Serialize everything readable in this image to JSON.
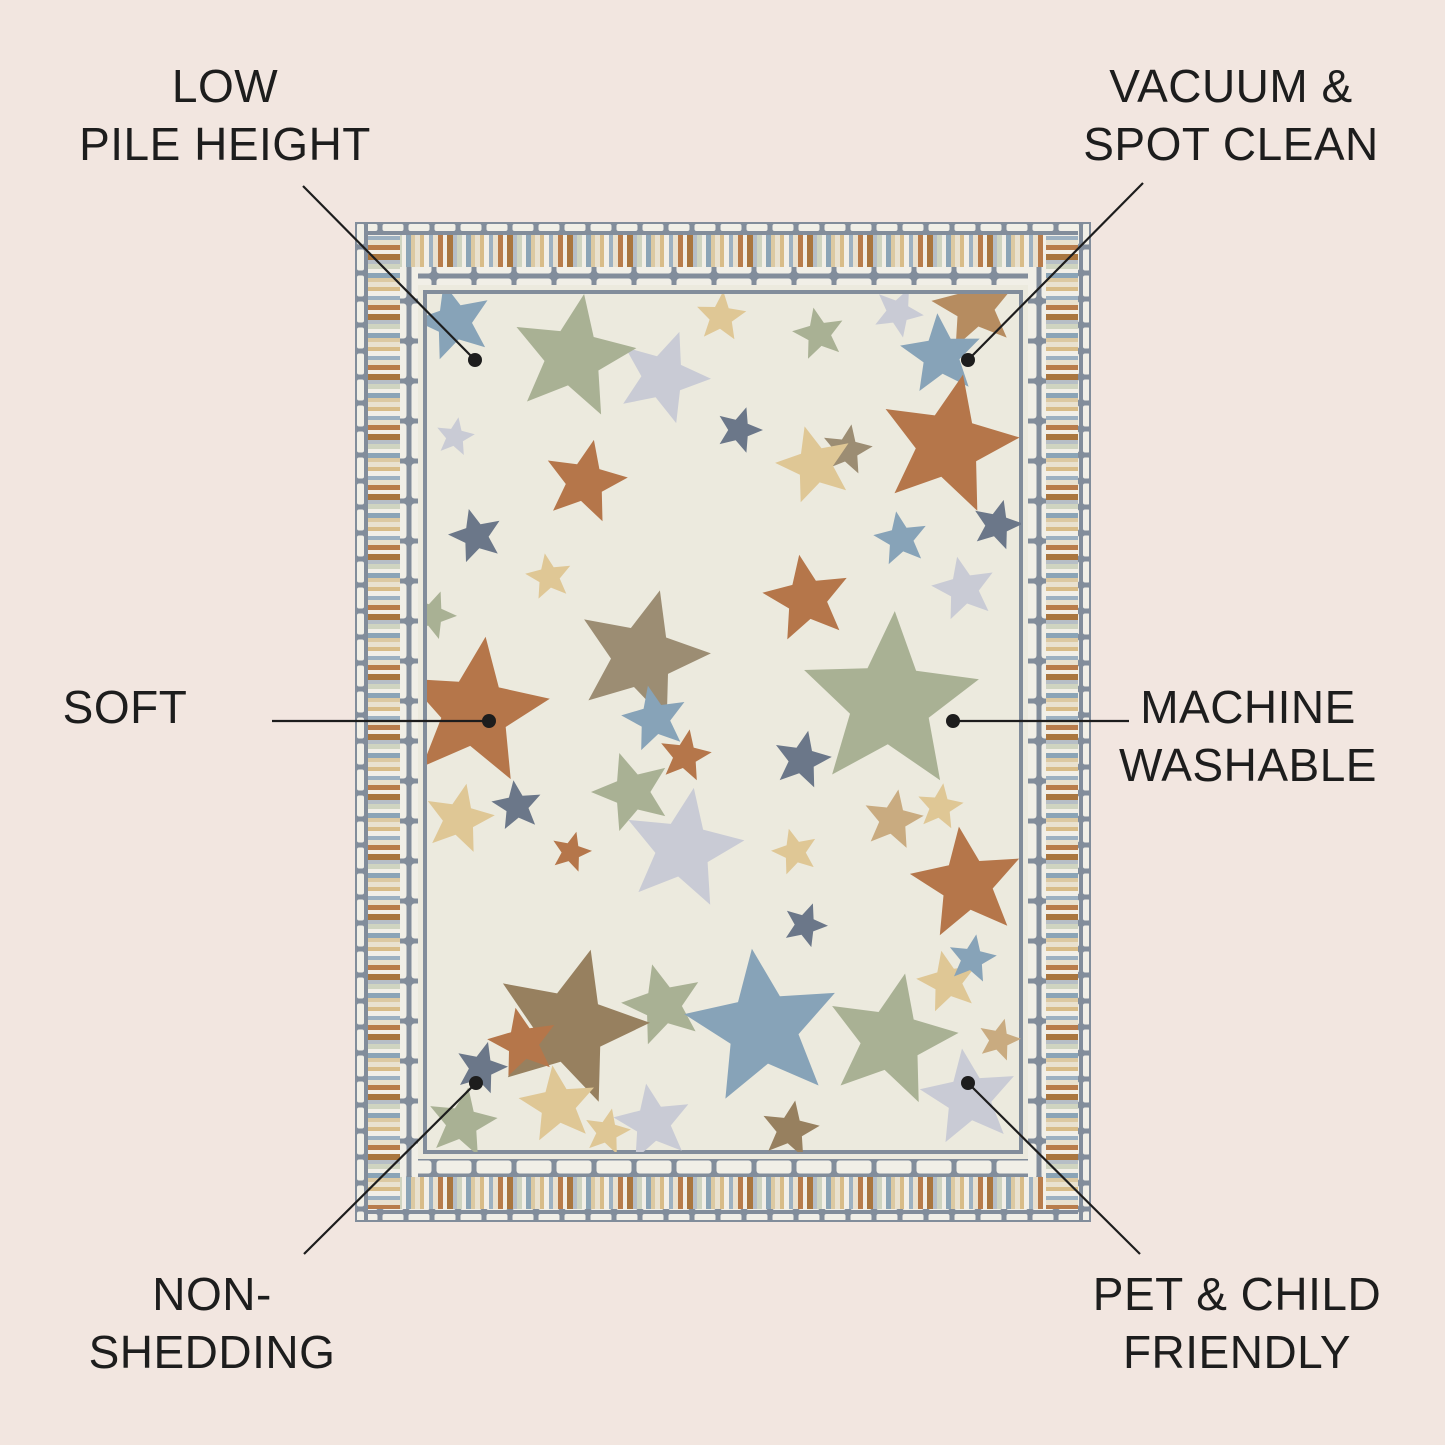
{
  "page": {
    "background": "#f2e6e0",
    "text_color": "#1d1d1d",
    "line_color": "#1d1d1d",
    "dot_radius": 7
  },
  "features": {
    "low_pile": {
      "line1": "LOW",
      "line2": "PILE HEIGHT"
    },
    "vacuum": {
      "line1": "VACUUM &",
      "line2": "SPOT CLEAN"
    },
    "soft": {
      "line1": "SOFT"
    },
    "machine_washable": {
      "line1": "MACHINE",
      "line2": "WASHABLE"
    },
    "non_shedding": {
      "line1": "NON-",
      "line2": "SHEDDING"
    },
    "pet_child": {
      "line1": "PET & CHILD",
      "line2": "FRIENDLY"
    }
  },
  "callouts": [
    {
      "name": "low-pile",
      "x1": 303,
      "y1": 186,
      "x2": 475,
      "y2": 360
    },
    {
      "name": "vacuum-spot-clean",
      "x1": 1143,
      "y1": 183,
      "x2": 968,
      "y2": 360
    },
    {
      "name": "soft",
      "x1": 272,
      "y1": 721,
      "x2": 489,
      "y2": 721
    },
    {
      "name": "machine-washable",
      "x1": 1129,
      "y1": 721,
      "x2": 953,
      "y2": 721
    },
    {
      "name": "non-shedding",
      "x1": 304,
      "y1": 1254,
      "x2": 476,
      "y2": 1083
    },
    {
      "name": "pet-child-friendly",
      "x1": 1140,
      "y1": 1254,
      "x2": 968,
      "y2": 1083
    }
  ],
  "rug": {
    "x": 355,
    "y": 222,
    "width": 736,
    "height": 1000,
    "field_color": "#eceade",
    "border_gray": "#828d9b",
    "brick_color": "#f1efe7",
    "stripe_widths": [
      5,
      4,
      5,
      4,
      5,
      5,
      4,
      6,
      4,
      5,
      4,
      5,
      4
    ],
    "stripe_colors": [
      "#e9e1cf",
      "#d8bc88",
      "#f2efe7",
      "#9db1c1",
      "#e9e1cf",
      "#b87c4b",
      "#f2efe7",
      "#a9763f",
      "#b6bec6",
      "#cfd4c0",
      "#f2efe7",
      "#8ba4b6",
      "#dcc9a2"
    ],
    "star_colors": {
      "blue": "#87a3b8",
      "sage": "#a9b194",
      "lgray": "#c9cbd5",
      "gold": "#dfc795",
      "rust": "#b5764a",
      "tanbrown": "#b68c60",
      "taupe": "#9c8d73",
      "slate": "#6b7789",
      "brown": "#97805f",
      "tan": "#c9ab80"
    },
    "stars": [
      [
        99,
        100,
        40,
        "blue",
        -15
      ],
      [
        308,
        155,
        48,
        "lgray",
        20
      ],
      [
        218,
        135,
        64,
        "sage",
        10
      ],
      [
        366,
        95,
        26,
        "gold",
        5
      ],
      [
        464,
        112,
        27,
        "sage",
        -12
      ],
      [
        543,
        90,
        26,
        "lgray",
        25
      ],
      [
        620,
        85,
        44,
        "tanbrown",
        -10
      ],
      [
        586,
        133,
        42,
        "blue",
        -5
      ],
      [
        384,
        208,
        24,
        "slate",
        18
      ],
      [
        492,
        228,
        26,
        "taupe",
        10
      ],
      [
        460,
        243,
        40,
        "gold",
        -15
      ],
      [
        593,
        223,
        72,
        "rust",
        12
      ],
      [
        642,
        303,
        26,
        "slate",
        15
      ],
      [
        546,
        317,
        28,
        "blue",
        -10
      ],
      [
        100,
        215,
        20,
        "lgray",
        10
      ],
      [
        121,
        314,
        28,
        "slate",
        -15
      ],
      [
        230,
        260,
        43,
        "rust",
        12
      ],
      [
        77,
        393,
        25,
        "sage",
        20
      ],
      [
        194,
        355,
        24,
        "gold",
        -10
      ],
      [
        120,
        490,
        76,
        "rust",
        8
      ],
      [
        287,
        435,
        69,
        "taupe",
        15
      ],
      [
        300,
        497,
        34,
        "blue",
        -12
      ],
      [
        330,
        534,
        27,
        "rust",
        10
      ],
      [
        277,
        570,
        41,
        "sage",
        -18
      ],
      [
        104,
        597,
        36,
        "gold",
        12
      ],
      [
        162,
        584,
        26,
        "slate",
        -8
      ],
      [
        216,
        630,
        21,
        "rust",
        15
      ],
      [
        452,
        377,
        45,
        "rust",
        -10
      ],
      [
        447,
        538,
        30,
        "slate",
        12
      ],
      [
        535,
        481,
        92,
        "sage",
        3
      ],
      [
        609,
        367,
        33,
        "lgray",
        -12
      ],
      [
        440,
        630,
        24,
        "gold",
        -15
      ],
      [
        538,
        598,
        31,
        "tan",
        10
      ],
      [
        328,
        627,
        62,
        "lgray",
        10
      ],
      [
        612,
        662,
        58,
        "rust",
        -8
      ],
      [
        450,
        703,
        23,
        "slate",
        20
      ],
      [
        593,
        760,
        32,
        "gold",
        -12
      ],
      [
        617,
        737,
        25,
        "blue",
        10
      ],
      [
        585,
        585,
        24,
        "gold",
        8
      ],
      [
        308,
        783,
        42,
        "sage",
        -15
      ],
      [
        215,
        805,
        80,
        "brown",
        15
      ],
      [
        435,
        908,
        30,
        "brown",
        10
      ],
      [
        408,
        806,
        80,
        "blue",
        -8
      ],
      [
        536,
        818,
        68,
        "sage",
        12
      ],
      [
        298,
        901,
        40,
        "lgray",
        -10
      ],
      [
        168,
        821,
        36,
        "rust",
        -12
      ],
      [
        126,
        846,
        27,
        "slate",
        15
      ],
      [
        203,
        883,
        40,
        "gold",
        -8
      ],
      [
        107,
        901,
        36,
        "sage",
        10
      ],
      [
        252,
        910,
        24,
        "gold",
        12
      ],
      [
        614,
        876,
        50,
        "lgray",
        -8
      ],
      [
        644,
        818,
        22,
        "tan",
        15
      ]
    ]
  }
}
